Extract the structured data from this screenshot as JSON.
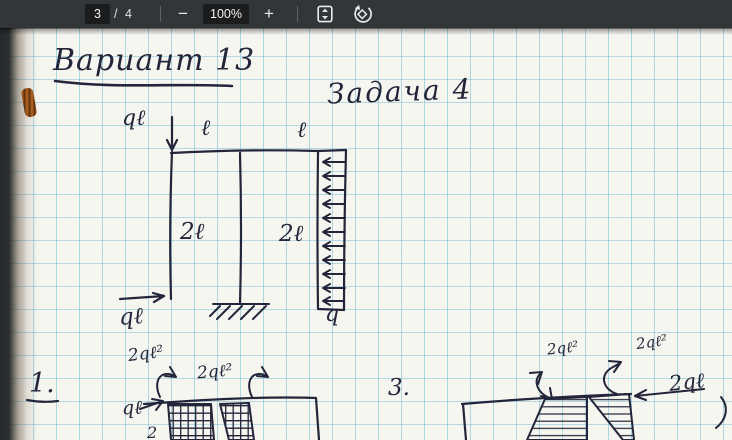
{
  "toolbar": {
    "page_current": "3",
    "page_count": "/ 4",
    "zoom_level": "100%",
    "zoom_out": "−",
    "zoom_in": "+",
    "fit_icon": "fit-to-page-icon",
    "rotate_icon": "rotate-counterclockwise-icon"
  },
  "page": {
    "title": "Вариант 13",
    "task_label": "Задача 4",
    "frame": {
      "top_force": "qℓ",
      "span_left": "ℓ",
      "span_right": "ℓ",
      "height_left": "2ℓ",
      "height_right": "2ℓ",
      "distributed_load": "q",
      "bottom_force": "qℓ"
    },
    "diagram1": {
      "number": "1.",
      "moment_left": "2qℓ²",
      "moment_right": "2qℓ²",
      "force": "qℓ",
      "partial_label": "2"
    },
    "diagram3": {
      "number": "3.",
      "moment_left": "2qℓ²",
      "moment_right": "2qℓ²",
      "force": "2qℓ"
    }
  },
  "colors": {
    "toolbar_bg": "#323639",
    "toolbar_field_bg": "#1a1c1e",
    "toolbar_text": "#f1f3f4",
    "paper": "#f7f5f0",
    "grid_line": "#7dc3d7",
    "ink": "#23253a"
  }
}
